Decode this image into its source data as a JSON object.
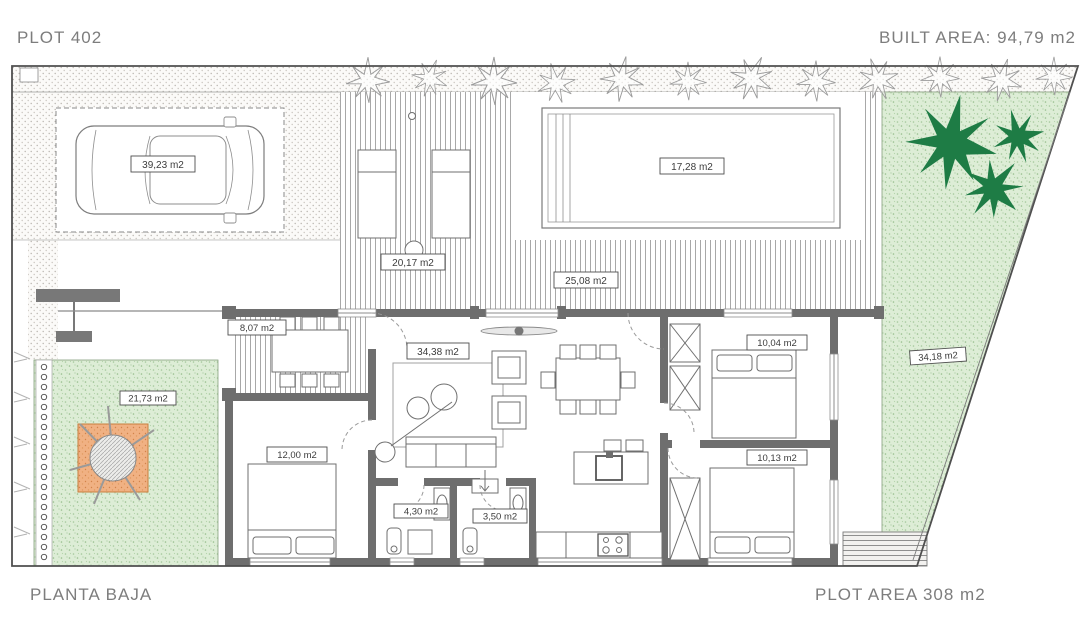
{
  "page": {
    "top_left": "PLOT 402",
    "top_right": "BUILT AREA: 94,79 m2",
    "bottom_left": "PLANTA BAJA",
    "bottom_right": "PLOT AREA 308 m2"
  },
  "areas": {
    "carport": "39,23 m2",
    "pool": "17,28 m2",
    "side_terrace": "20,17 m2",
    "main_terrace": "25,08 m2",
    "porch": "8,07 m2",
    "living_kitchen": "34,38 m2",
    "bedroom_top_right": "10,04 m2",
    "bedroom_bottom_right": "10,13 m2",
    "bedroom_left": "12,00 m2",
    "bathroom_left": "4,30 m2",
    "bathroom_right": "3,50 m2",
    "garden_left": "21,73 m2",
    "garden_right": "34,18 m2"
  },
  "colors": {
    "text_gray": "#7d7d7d",
    "wall_gray": "#6e6e6e",
    "line_gray": "#8e8e8e",
    "garden_green": "#ddedd6",
    "garden_speckle": "#96bd8c",
    "plant_green": "#1e7c45",
    "tree_patch_orange": "#f0b183",
    "label_text": "#3c3c3c"
  }
}
